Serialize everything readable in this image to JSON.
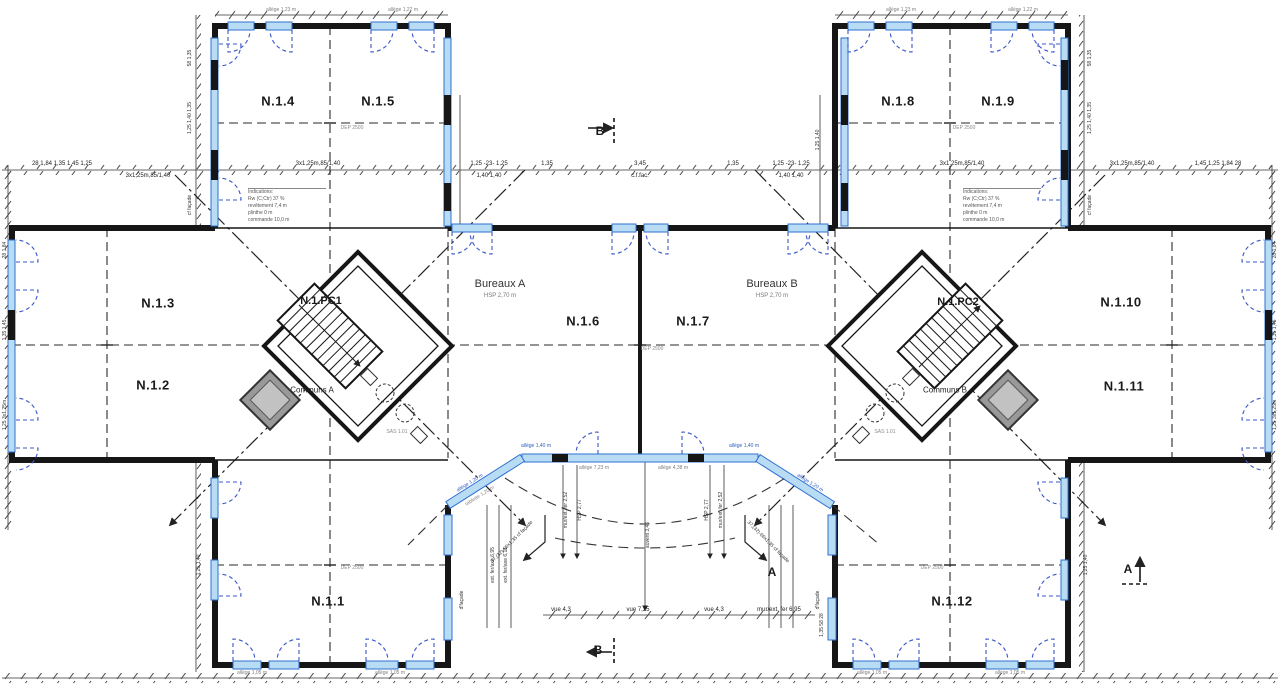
{
  "rooms": {
    "n11": "N.1.1",
    "n12": "N.1.2",
    "n13": "N.1.3",
    "n14": "N.1.4",
    "n15": "N.1.5",
    "n16": "N.1.6",
    "n17": "N.1.7",
    "n18": "N.1.8",
    "n19": "N.1.9",
    "n110": "N.1.10",
    "n111": "N.1.11",
    "n112": "N.1.12"
  },
  "cores": {
    "pc1": "N.1.PC1",
    "pc2": "N.1.PC2",
    "communs_a": "Communs A",
    "communs_b": "Communs B",
    "sas": "SAS 1.01"
  },
  "zones": {
    "bureaux_a": "Bureaux A",
    "bureaux_b": "Bureaux B",
    "hsp": "HSP 2,70 m"
  },
  "markers": {
    "a": "A",
    "b": "B"
  },
  "dims": {
    "chain_left": "28  1,84  1,35  1,45  1,25",
    "chain_3x": "3x1,25m,85/1,40",
    "chain_125": "1,25 -23- 1,25",
    "chain_140": "1,40      1,40",
    "chain_135": "1,35",
    "chain_345": "3,45",
    "chain_cffac": "c.f.fac.",
    "chain_right": "1,45  1,25  1,84  28",
    "v58": "58  1,35",
    "v125": "1,25  1,40  1,35",
    "vcf": "cf façade",
    "v28": "28  1,84",
    "v135": "1,35  1,45",
    "v3x": "1,25  3x1,25m",
    "v1214": "1,25  1,40",
    "v1355828": "1,35  58  28",
    "vfacade": "d'façade",
    "extfer695": "ext. fer/axe 6,95",
    "extfer611": "ext. fer/axe 6,11",
    "mur252": "mur/ext. fer 2,52",
    "hsp277": "HSP 2,77",
    "auvent": "auvent 3,46",
    "vue43": "vue 4,3",
    "vue725": "vue 7,25",
    "mur695": "mur/ext. fer 6,95",
    "diag": "37,(32)-66x1,35 cf façade",
    "allege123": "allège 1,23 m",
    "allege122": "allège 1,22 m",
    "allege105": "allège 1,05 m",
    "allege723": "allège 7,23 m",
    "allege438": "allège 4,38 m",
    "allege120": "allège 1,20 m",
    "allege140": "allège 1,40 m",
    "tablette": "tablette 1,20 m",
    "dep": "DEP 2500"
  },
  "info_block": {
    "l1": "Indications:",
    "l2": "Rw (C;Ctr)    37 %",
    "l3": "revêtement   7,4 m",
    "l4": "plinthe         0 m",
    "l5": "commande   10,0 m"
  },
  "colors": {
    "wall": "#161616",
    "glazing": "#2f6fd0",
    "glazing_fill": "#b8dcf4",
    "swing": "#3a57c8",
    "dim": "#333333",
    "elevator": "#999999"
  }
}
